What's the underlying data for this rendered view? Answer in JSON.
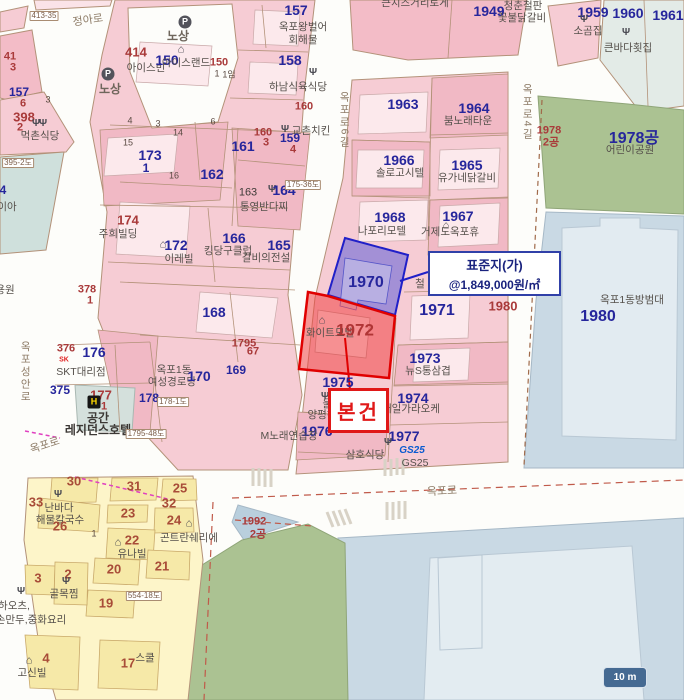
{
  "map": {
    "callout_standard": {
      "line1": "표준지(가)",
      "line2": "@1,849,000원/㎡"
    },
    "callout_subject": {
      "label": "본건"
    },
    "scale_bar": {
      "label": "10 m"
    },
    "brand_colors": {
      "parcel_blue": "#26269c",
      "parcel_red": "#a93a3a",
      "subject_red": "#e01818",
      "standard_navy": "#3040a8",
      "park_green": "#abc292",
      "water_blue": "#c9d9e4",
      "zone_pink": "#f6ccd4",
      "zone_yellow": "#fdf5c9"
    },
    "icon_glyphs": {
      "fork": "Ψ",
      "house": "⌂",
      "parking": "P",
      "hotel": "H",
      "sk": "SK"
    },
    "labels": [
      {
        "t": "413-35",
        "c": "marker",
        "x": 44,
        "y": 16
      },
      {
        "t": "정아로",
        "c": "road",
        "x": 88,
        "y": 21,
        "r": -8
      },
      {
        "icon": "parking",
        "x": 185,
        "y": 22
      },
      {
        "t": "노상",
        "c": "road2",
        "x": 178,
        "y": 36
      },
      {
        "icon": "parking",
        "x": 108,
        "y": 74
      },
      {
        "t": "노상",
        "c": "road2",
        "x": 110,
        "y": 89
      },
      {
        "t": "41",
        "c": "red",
        "x": 10,
        "y": 57
      },
      {
        "t": "3",
        "c": "red",
        "x": 13,
        "y": 68
      },
      {
        "t": "414",
        "c": "red-lg",
        "x": 136,
        "y": 52
      },
      {
        "t": "아이스빈",
        "c": "name",
        "x": 146,
        "y": 68
      },
      {
        "icon": "house",
        "x": 181,
        "y": 50
      },
      {
        "t": "150",
        "c": "blue-lg",
        "x": 167,
        "y": 60
      },
      {
        "t": "아이스랜드",
        "c": "name",
        "x": 186,
        "y": 63
      },
      {
        "t": "150",
        "c": "red",
        "x": 219,
        "y": 63
      },
      {
        "t": "1",
        "c": "tiny",
        "x": 217,
        "y": 74
      },
      {
        "t": "1임",
        "c": "tiny",
        "x": 229,
        "y": 75
      },
      {
        "t": "157",
        "c": "blue-lg",
        "x": 296,
        "y": 10
      },
      {
        "t": "옥포왕벌어",
        "c": "name",
        "x": 303,
        "y": 27
      },
      {
        "t": "회해물",
        "c": "name",
        "x": 303,
        "y": 40
      },
      {
        "t": "158",
        "c": "blue-lg",
        "x": 290,
        "y": 60
      },
      {
        "icon": "fork",
        "x": 313,
        "y": 73
      },
      {
        "t": "하남식육식당",
        "c": "name",
        "x": 298,
        "y": 87
      },
      {
        "t": "160",
        "c": "red",
        "x": 304,
        "y": 107
      },
      {
        "icon": "fork",
        "x": 285,
        "y": 130
      },
      {
        "t": "교촌치킨",
        "c": "name",
        "x": 311,
        "y": 131
      },
      {
        "t": "157",
        "c": "blue",
        "x": 19,
        "y": 92
      },
      {
        "t": "6",
        "c": "red",
        "x": 23,
        "y": 104
      },
      {
        "t": "3",
        "c": "tiny",
        "x": 48,
        "y": 100
      },
      {
        "t": "398",
        "c": "red-lg",
        "x": 24,
        "y": 117
      },
      {
        "t": "2",
        "c": "red",
        "x": 20,
        "y": 128
      },
      {
        "icon": "fork",
        "x": 36,
        "y": 124
      },
      {
        "icon": "fork",
        "x": 43,
        "y": 124
      },
      {
        "t": "먹촌식당",
        "c": "name",
        "x": 40,
        "y": 136
      },
      {
        "t": "395-2도",
        "c": "marker",
        "x": 18,
        "y": 163
      },
      {
        "t": "4",
        "c": "blue",
        "x": 3,
        "y": 190
      },
      {
        "t": "이아",
        "c": "name",
        "x": 7,
        "y": 207
      },
      {
        "t": "용원",
        "c": "name",
        "x": 5,
        "y": 290
      },
      {
        "t": "378",
        "c": "red",
        "x": 87,
        "y": 290
      },
      {
        "t": "1",
        "c": "red",
        "x": 90,
        "y": 301
      },
      {
        "t": "173",
        "c": "blue-lg",
        "x": 150,
        "y": 155
      },
      {
        "t": "1",
        "c": "blue",
        "x": 146,
        "y": 168
      },
      {
        "t": "4",
        "c": "tiny",
        "x": 130,
        "y": 121
      },
      {
        "t": "3",
        "c": "tiny",
        "x": 158,
        "y": 124
      },
      {
        "t": "14",
        "c": "tiny",
        "x": 178,
        "y": 133
      },
      {
        "t": "15",
        "c": "tiny",
        "x": 128,
        "y": 143
      },
      {
        "t": "16",
        "c": "tiny",
        "x": 174,
        "y": 176
      },
      {
        "t": "6",
        "c": "tiny",
        "x": 213,
        "y": 122
      },
      {
        "t": "162",
        "c": "blue-lg",
        "x": 212,
        "y": 174
      },
      {
        "t": "161",
        "c": "blue-lg",
        "x": 243,
        "y": 146
      },
      {
        "t": "160",
        "c": "red",
        "x": 263,
        "y": 133
      },
      {
        "t": "3",
        "c": "red",
        "x": 266,
        "y": 143
      },
      {
        "t": "159",
        "c": "blue",
        "x": 290,
        "y": 138
      },
      {
        "t": "4",
        "c": "red",
        "x": 293,
        "y": 150
      },
      {
        "t": "163",
        "c": "dk",
        "x": 248,
        "y": 193
      },
      {
        "icon": "fork",
        "x": 272,
        "y": 190
      },
      {
        "t": "164",
        "c": "blue-lg",
        "x": 284,
        "y": 190
      },
      {
        "t": "175-36도",
        "c": "marker",
        "x": 303,
        "y": 185
      },
      {
        "t": "통영반다찌",
        "c": "name",
        "x": 264,
        "y": 207
      },
      {
        "t": "174",
        "c": "red-lg",
        "x": 128,
        "y": 220
      },
      {
        "t": "주희빌딩",
        "c": "name",
        "x": 118,
        "y": 234
      },
      {
        "icon": "house",
        "x": 163,
        "y": 245
      },
      {
        "t": "172",
        "c": "blue-lg",
        "x": 176,
        "y": 245
      },
      {
        "t": "이레빌",
        "c": "name",
        "x": 179,
        "y": 259
      },
      {
        "t": "166",
        "c": "blue-lg",
        "x": 234,
        "y": 238
      },
      {
        "t": "킹당구클럽",
        "c": "name",
        "x": 228,
        "y": 251
      },
      {
        "t": "165",
        "c": "blue-lg",
        "x": 279,
        "y": 245
      },
      {
        "t": "갈비의전설",
        "c": "name",
        "x": 266,
        "y": 258
      },
      {
        "t": "168",
        "c": "blue-lg",
        "x": 214,
        "y": 312
      },
      {
        "t": "1795",
        "c": "red",
        "x": 244,
        "y": 344
      },
      {
        "t": "67",
        "c": "red",
        "x": 253,
        "y": 352
      },
      {
        "t": "169",
        "c": "blue",
        "x": 236,
        "y": 370
      },
      {
        "t": "옥포1동",
        "c": "name",
        "x": 174,
        "y": 370
      },
      {
        "t": "여성경로당",
        "c": "name",
        "x": 172,
        "y": 382
      },
      {
        "t": "170",
        "c": "blue-lg",
        "x": 199,
        "y": 376
      },
      {
        "t": "178",
        "c": "blue",
        "x": 149,
        "y": 398
      },
      {
        "t": "178-1도",
        "c": "marker",
        "x": 173,
        "y": 402
      },
      {
        "t": "376",
        "c": "red",
        "x": 66,
        "y": 349
      },
      {
        "icon": "sk",
        "x": 64,
        "y": 360
      },
      {
        "t": "176",
        "c": "blue-lg",
        "x": 94,
        "y": 352
      },
      {
        "t": "SKT대리점",
        "c": "name",
        "x": 81,
        "y": 372
      },
      {
        "t": "375",
        "c": "blue",
        "x": 60,
        "y": 390
      },
      {
        "t": "177",
        "c": "red-lg",
        "x": 101,
        "y": 395
      },
      {
        "t": "1",
        "c": "red",
        "x": 104,
        "y": 407
      },
      {
        "icon": "hotel",
        "x": 94,
        "y": 402
      },
      {
        "t": "공간",
        "c": "name-lg",
        "x": 98,
        "y": 418
      },
      {
        "t": "레지던스호텔",
        "c": "name-lg",
        "x": 98,
        "y": 430
      },
      {
        "t": "옥포성안로",
        "c": "vroad",
        "x": 25,
        "y": 372
      },
      {
        "t": "옥포로",
        "c": "road",
        "x": 45,
        "y": 446,
        "r": -18
      },
      {
        "t": "1795-48도",
        "c": "marker",
        "x": 146,
        "y": 434
      },
      {
        "t": "큰치즈거리토게",
        "c": "name",
        "x": 415,
        "y": 3
      },
      {
        "t": "1949",
        "c": "blue-lg",
        "x": 489,
        "y": 11
      },
      {
        "t": "청춘철판",
        "c": "name",
        "x": 523,
        "y": 6
      },
      {
        "t": "꽃불닭갈비",
        "c": "name",
        "x": 522,
        "y": 18
      },
      {
        "t": "1959",
        "c": "blue-lg",
        "x": 593,
        "y": 12
      },
      {
        "icon": "fork",
        "x": 584,
        "y": 20
      },
      {
        "t": "소곰집",
        "c": "name",
        "x": 588,
        "y": 31
      },
      {
        "t": "1960",
        "c": "blue-lg",
        "x": 628,
        "y": 13
      },
      {
        "t": "1961",
        "c": "blue-lg",
        "x": 668,
        "y": 15
      },
      {
        "icon": "fork",
        "x": 626,
        "y": 33
      },
      {
        "t": "큰바다횟집",
        "c": "name",
        "x": 628,
        "y": 48
      },
      {
        "t": "1963",
        "c": "blue-lg",
        "x": 403,
        "y": 104
      },
      {
        "t": "1964",
        "c": "blue-lg",
        "x": 474,
        "y": 108
      },
      {
        "t": "붐노래타운",
        "c": "name",
        "x": 468,
        "y": 121
      },
      {
        "t": "옥포로6길",
        "c": "vroad",
        "x": 344,
        "y": 120
      },
      {
        "t": "옥포로4길",
        "c": "vroad",
        "x": 527,
        "y": 112
      },
      {
        "t": "1966",
        "c": "blue-lg",
        "x": 399,
        "y": 160
      },
      {
        "t": "솔로고시텔",
        "c": "name",
        "x": 400,
        "y": 173
      },
      {
        "t": "1965",
        "c": "blue-lg",
        "x": 467,
        "y": 165
      },
      {
        "t": "유가네닭갈비",
        "c": "name",
        "x": 467,
        "y": 178
      },
      {
        "t": "1968",
        "c": "blue-lg",
        "x": 390,
        "y": 217
      },
      {
        "t": "나포리모텔",
        "c": "name",
        "x": 382,
        "y": 231
      },
      {
        "t": "1967",
        "c": "blue-lg",
        "x": 458,
        "y": 216
      },
      {
        "icon": "house",
        "x": 446,
        "y": 226
      },
      {
        "t": "거제도옥포휴",
        "c": "name",
        "x": 450,
        "y": 232
      },
      {
        "t": "1970",
        "c": "blue-xl",
        "x": 366,
        "y": 283
      },
      {
        "t": "철",
        "c": "name",
        "x": 420,
        "y": 284
      },
      {
        "t": "1971",
        "c": "blue-xl",
        "x": 437,
        "y": 311
      },
      {
        "icon": "house",
        "x": 322,
        "y": 321
      },
      {
        "t": "화이트모텔",
        "c": "name",
        "x": 330,
        "y": 333
      },
      {
        "t": "1972",
        "c": "red-xl",
        "x": 355,
        "y": 330
      },
      {
        "t": "1973",
        "c": "blue-lg",
        "x": 425,
        "y": 358
      },
      {
        "t": "뉴S통삼겹",
        "c": "name",
        "x": 428,
        "y": 371
      },
      {
        "t": "1975",
        "c": "blue-lg",
        "x": 338,
        "y": 382
      },
      {
        "icon": "fork",
        "x": 325,
        "y": 397
      },
      {
        "t": "울엄",
        "c": "name",
        "x": 332,
        "y": 404
      },
      {
        "t": "양평해",
        "c": "name",
        "x": 322,
        "y": 415
      },
      {
        "t": "1974",
        "c": "blue-lg",
        "x": 413,
        "y": 398
      },
      {
        "t": "대일가라오케",
        "c": "name",
        "x": 411,
        "y": 409
      },
      {
        "t": "1976",
        "c": "blue-lg",
        "x": 317,
        "y": 431
      },
      {
        "t": "M노래연습장",
        "c": "name",
        "x": 289,
        "y": 436
      },
      {
        "t": "1977",
        "c": "blue-lg",
        "x": 404,
        "y": 436
      },
      {
        "icon": "fork",
        "x": 388,
        "y": 443
      },
      {
        "t": "삼호식당",
        "c": "name",
        "x": 365,
        "y": 455
      },
      {
        "t": "GS25",
        "c": "gs",
        "x": 412,
        "y": 451
      },
      {
        "t": "GS25",
        "c": "name",
        "x": 415,
        "y": 463
      },
      {
        "t": "1978",
        "c": "red",
        "x": 549,
        "y": 131
      },
      {
        "t": "2공",
        "c": "red",
        "x": 551,
        "y": 143
      },
      {
        "t": "1978공",
        "c": "blue-xl",
        "x": 634,
        "y": 139
      },
      {
        "t": "어린이공원",
        "c": "name",
        "x": 630,
        "y": 150
      },
      {
        "t": "1980",
        "c": "red-lg",
        "x": 503,
        "y": 306
      },
      {
        "t": "1980",
        "c": "blue-xl",
        "x": 598,
        "y": 317
      },
      {
        "t": "옥포1동방범대",
        "c": "name",
        "x": 632,
        "y": 300
      },
      {
        "t": "1992",
        "c": "red",
        "x": 254,
        "y": 522
      },
      {
        "t": "2공",
        "c": "red",
        "x": 258,
        "y": 535
      },
      {
        "t": "옥포로",
        "c": "road",
        "x": 442,
        "y": 492,
        "r": -3
      },
      {
        "t": "30",
        "c": "red-y",
        "x": 74,
        "y": 481
      },
      {
        "t": "31",
        "c": "red-y",
        "x": 134,
        "y": 486
      },
      {
        "t": "25",
        "c": "red-y",
        "x": 180,
        "y": 488
      },
      {
        "t": "33",
        "c": "red-y",
        "x": 36,
        "y": 502
      },
      {
        "t": "32",
        "c": "red-y",
        "x": 169,
        "y": 503
      },
      {
        "icon": "fork",
        "x": 58,
        "y": 495
      },
      {
        "t": "난바다",
        "c": "name",
        "x": 59,
        "y": 508
      },
      {
        "t": "해물칼국수",
        "c": "name",
        "x": 60,
        "y": 520
      },
      {
        "t": "23",
        "c": "red-y",
        "x": 128,
        "y": 513
      },
      {
        "t": "24",
        "c": "red-y",
        "x": 174,
        "y": 520
      },
      {
        "t": "26",
        "c": "red-y",
        "x": 60,
        "y": 526
      },
      {
        "icon": "house",
        "x": 189,
        "y": 524
      },
      {
        "t": "곤트란쉐리에",
        "c": "name",
        "x": 189,
        "y": 538
      },
      {
        "t": "1",
        "c": "tiny",
        "x": 94,
        "y": 534
      },
      {
        "t": "22",
        "c": "red-y",
        "x": 132,
        "y": 540
      },
      {
        "icon": "house",
        "x": 118,
        "y": 543
      },
      {
        "t": "유나빌",
        "c": "name",
        "x": 132,
        "y": 554
      },
      {
        "t": "20",
        "c": "red-y",
        "x": 114,
        "y": 569
      },
      {
        "t": "21",
        "c": "red-y",
        "x": 162,
        "y": 566
      },
      {
        "t": "3",
        "c": "red-y",
        "x": 38,
        "y": 578
      },
      {
        "t": "2",
        "c": "red-y",
        "x": 68,
        "y": 574
      },
      {
        "icon": "fork",
        "x": 66,
        "y": 582
      },
      {
        "t": "골목찜",
        "c": "name",
        "x": 64,
        "y": 594
      },
      {
        "icon": "fork",
        "x": 21,
        "y": 592
      },
      {
        "t": "하오츠,",
        "c": "name",
        "x": 14,
        "y": 606
      },
      {
        "t": "손만두,중화요리",
        "c": "name",
        "x": 31,
        "y": 620
      },
      {
        "t": "19",
        "c": "red-y",
        "x": 106,
        "y": 603
      },
      {
        "t": "554-18도",
        "c": "marker",
        "x": 144,
        "y": 596
      },
      {
        "t": "4",
        "c": "red-y",
        "x": 46,
        "y": 658
      },
      {
        "icon": "house",
        "x": 29,
        "y": 661
      },
      {
        "t": "고신빌",
        "c": "name",
        "x": 32,
        "y": 673
      },
      {
        "t": "17",
        "c": "red-y",
        "x": 128,
        "y": 663
      },
      {
        "t": "스쿨",
        "c": "name",
        "x": 145,
        "y": 658
      }
    ]
  }
}
